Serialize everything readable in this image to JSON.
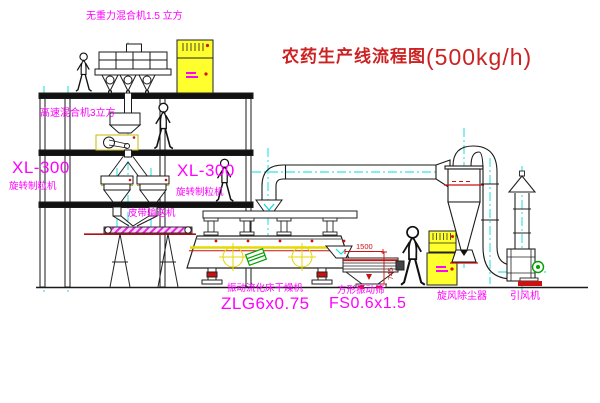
{
  "colors": {
    "label_magenta": "#ff00ff",
    "title_red": "#cc2222",
    "dim_red": "#cc1111",
    "equipment_yellow": "#ffff2e",
    "centerline_cyan": "#00dcdc",
    "machine_green": "#00a000",
    "line_black": "#1a1a1a"
  },
  "title": {
    "text": "农药生产线流程图",
    "capacity": "(500kg/h)"
  },
  "labels": {
    "gravity_mixer": "无重力混合机1.5 立方",
    "high_speed_mixer": "高速混合机3立方",
    "granulator_left_model": "XL-300",
    "granulator_left_name": "旋转制粒机",
    "granulator_mid_model": "XL-300",
    "granulator_mid_name": "旋转制粒机",
    "belt_conveyor": "皮带输送机",
    "fluid_bed_dryer_name": "振动流化床干燥机",
    "fluid_bed_dryer_model": "ZLG6x0.75",
    "vibrating_screen_name": "方形振动筛",
    "vibrating_screen_model": "FS0.6x1.5",
    "cyclone": "旋风除尘器",
    "induced_draft_fan": "引风机"
  },
  "dimensions": {
    "screen_length": "1500",
    "screen_height": "745"
  }
}
